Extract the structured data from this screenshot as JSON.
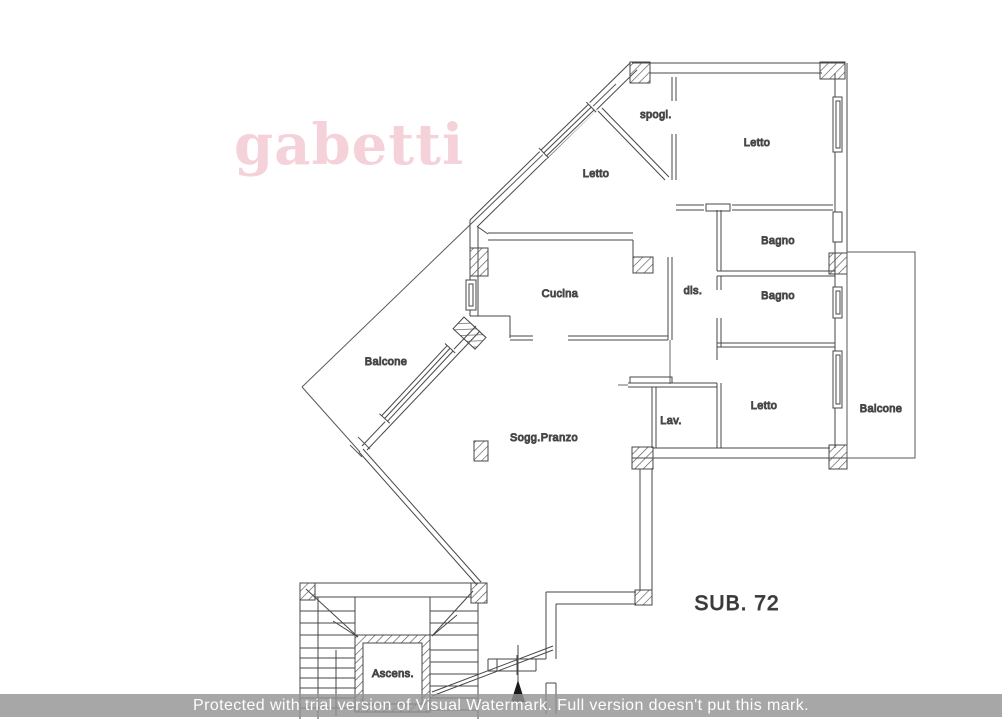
{
  "logo": {
    "text": "gabetti",
    "color": "#f5d2da"
  },
  "plan": {
    "unit_label": "SUB. 72",
    "line_color": "#474747",
    "rooms": [
      {
        "id": "spogliatoio",
        "label": "spogl."
      },
      {
        "id": "letto-nord",
        "label": "Letto"
      },
      {
        "id": "letto-nordest",
        "label": "Letto"
      },
      {
        "id": "bagno-1",
        "label": "Bagno"
      },
      {
        "id": "disimpegno",
        "label": "dis."
      },
      {
        "id": "bagno-2",
        "label": "Bagno"
      },
      {
        "id": "cucina",
        "label": "Cucina"
      },
      {
        "id": "balcone-ovest",
        "label": "Balcone"
      },
      {
        "id": "soggiorno-pranzo",
        "label": "Sogg.Pranzo"
      },
      {
        "id": "lavanderia",
        "label": "Lav."
      },
      {
        "id": "letto-sudest",
        "label": "Letto"
      },
      {
        "id": "balcone-est",
        "label": "Balcone"
      },
      {
        "id": "ascensore",
        "label": "Ascens."
      }
    ]
  },
  "watermark_banner": {
    "text": "Protected with trial version of Visual Watermark. Full version doesn't put this mark.",
    "background": "#949494",
    "text_color": "#fdfdfd"
  }
}
